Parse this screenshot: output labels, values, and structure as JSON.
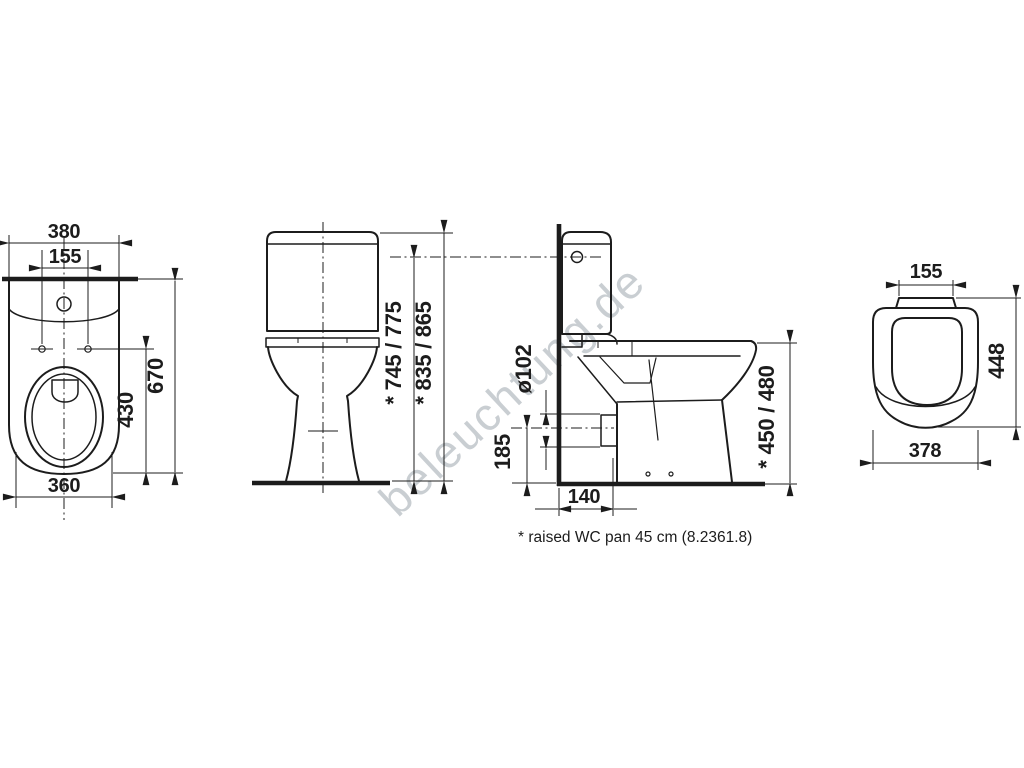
{
  "title": "WC pan technical drawing",
  "colors": {
    "background": "#ffffff",
    "line": "#1c1c1c",
    "waterline_gray": "#8c8c8c",
    "watermark": "#c9ced2"
  },
  "views": {
    "top": {
      "dim_width_top": "380",
      "dim_hole_spacing": "155",
      "dim_depth": "670",
      "dim_hole_depth": "430",
      "dim_width_bottom": "360"
    },
    "front": {
      "dim_height_to_lever": "* 745 / 775",
      "dim_height_total": "* 835 / 865"
    },
    "side": {
      "dim_outlet_diameter": "ø102",
      "dim_outlet_height": "185",
      "dim_outlet_offset": "140",
      "dim_rim_height": "* 450 / 480"
    },
    "seat": {
      "dim_hinge_width": "155",
      "dim_depth": "448",
      "dim_width": "378"
    }
  },
  "footnote": "* raised WC pan 45 cm (8.2361.8)",
  "watermark": "beleuchtung.de"
}
